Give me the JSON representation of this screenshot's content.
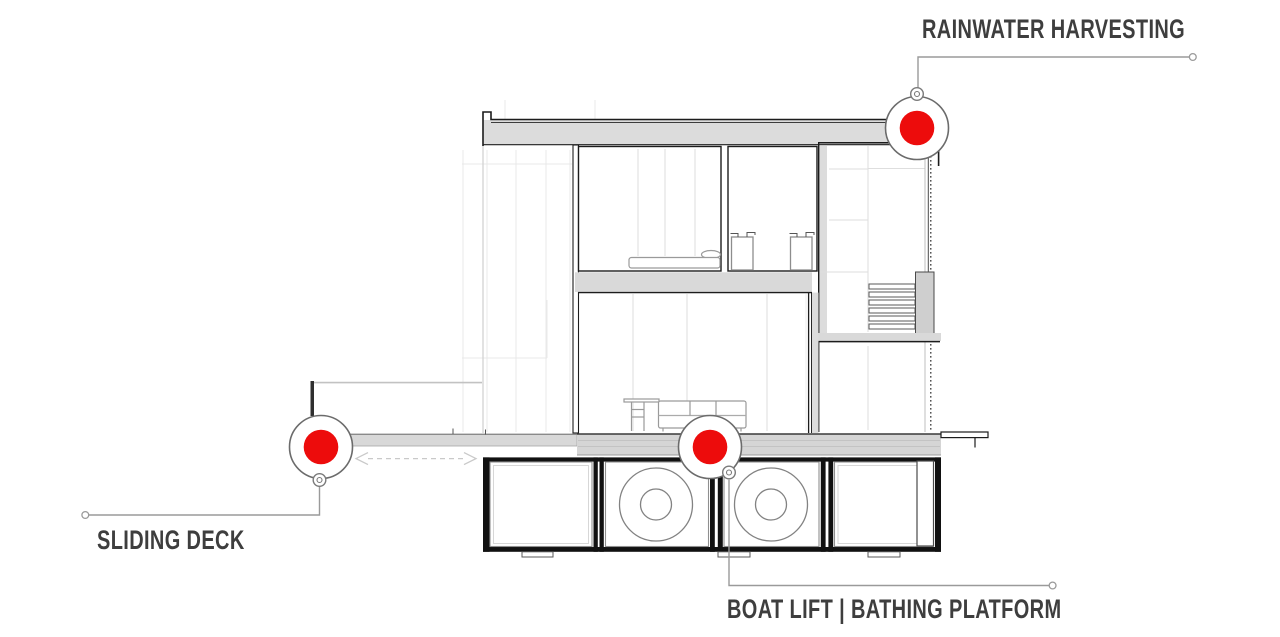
{
  "diagram": {
    "kind": "architectural-cross-section",
    "subject": "floating-house-section"
  },
  "annotations": {
    "rainwater": {
      "label": "RAINWATER HARVESTING"
    },
    "sliding_deck": {
      "label": "SLIDING DECK"
    },
    "boat_lift": {
      "label": "BOAT LIFT | BATHING PLATFORM"
    }
  },
  "icons": {
    "hotspot_marker": "red-dot-in-white-ring",
    "leader_endpoint": "small-hollow-circle",
    "marker_badge": "double-ring-circle",
    "slide_direction": "double-headed-dashed-arrow"
  },
  "colors": {
    "marker_red": "#ed0c0c",
    "marker_ring": "#6b6b6b",
    "leader": "#9a9a9a",
    "label_text": "#3e3e3e",
    "section_line_dark": "#1c1c1c",
    "slab_fill": "#d9d9d9"
  }
}
